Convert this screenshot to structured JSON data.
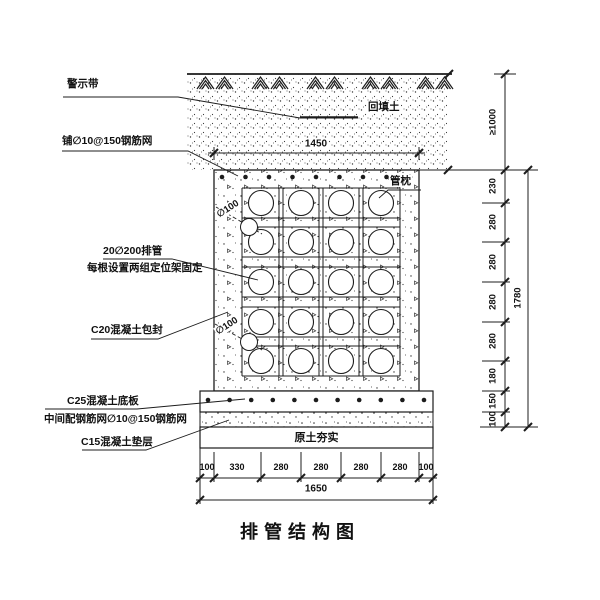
{
  "drawing": {
    "title": "排管结构图",
    "annotations": {
      "warning_tape": "警示带",
      "top_rebar_mesh": "铺∅10@150钢筋网",
      "backfill_soil": "回填土",
      "pipe_pillow": "管枕",
      "pipe_bank": "20∅200排管",
      "pipe_bank_note": "每根设置两组定位架固定",
      "drain_pipe_upper": "∅100",
      "drain_pipe_lower": "∅100",
      "encasement": "C20混凝土包封",
      "base_plate": "C25混凝土底板",
      "base_plate_mesh": "中间配钢筋网∅10@150钢筋网",
      "cushion": "C15混凝土垫层",
      "compacted_soil": "原土夯实"
    },
    "dimensions": {
      "top_width": "1450",
      "cover_depth": "≥1000",
      "right_segments": [
        "230",
        "280",
        "280",
        "280",
        "280",
        "180",
        "150",
        "100"
      ],
      "right_total": "1780",
      "bottom_segments": [
        "100",
        "330",
        "280",
        "280",
        "280",
        "280",
        "100"
      ],
      "bottom_total": "1650"
    },
    "colors": {
      "line": "#1c1c1c",
      "background": "#ffffff"
    }
  }
}
